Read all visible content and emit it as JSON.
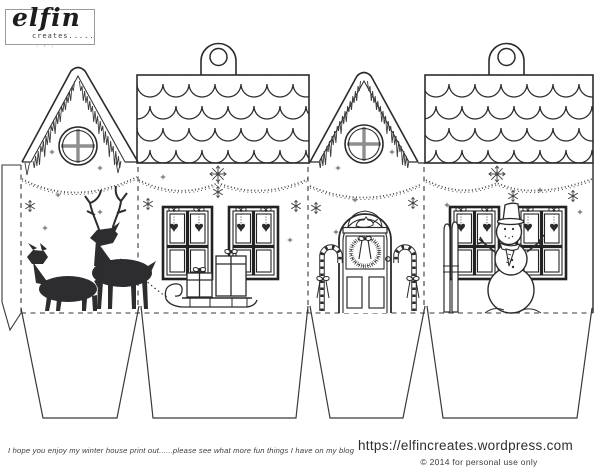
{
  "page": {
    "background": "#ffffff",
    "ink": "#2b2b2b",
    "mullion_gray": "#8f8f8f",
    "silhouette": "#2d2d30",
    "dash_color": "#3a3a3a"
  },
  "logo": {
    "name": "elfin",
    "tagline": "creates.....",
    "ornament": "· ◦ ·"
  },
  "footer": {
    "message": "I hope you enjoy my winter house print out......please see what more fun things I have on my blog",
    "url": "https://elfincreates.wordpress.com",
    "copyright": "© 2014  for personal use only"
  },
  "icons": {
    "snowflake": "snowflake-burst",
    "heart": "hanging-heart",
    "tab_hole": "string-hole"
  },
  "template_elements": [
    "gable-end-round-window",
    "icicle-roof-trim",
    "scalloped-roof-panel",
    "hanging-tab-with-hole",
    "stitched-garland",
    "reindeer-silhouettes",
    "sleigh-with-presents",
    "four-pane-windows",
    "hanging-hearts",
    "front-door-with-wreath",
    "candy-canes",
    "skis",
    "snowman",
    "fold-lines",
    "glue-tab",
    "bottom-flaps"
  ]
}
